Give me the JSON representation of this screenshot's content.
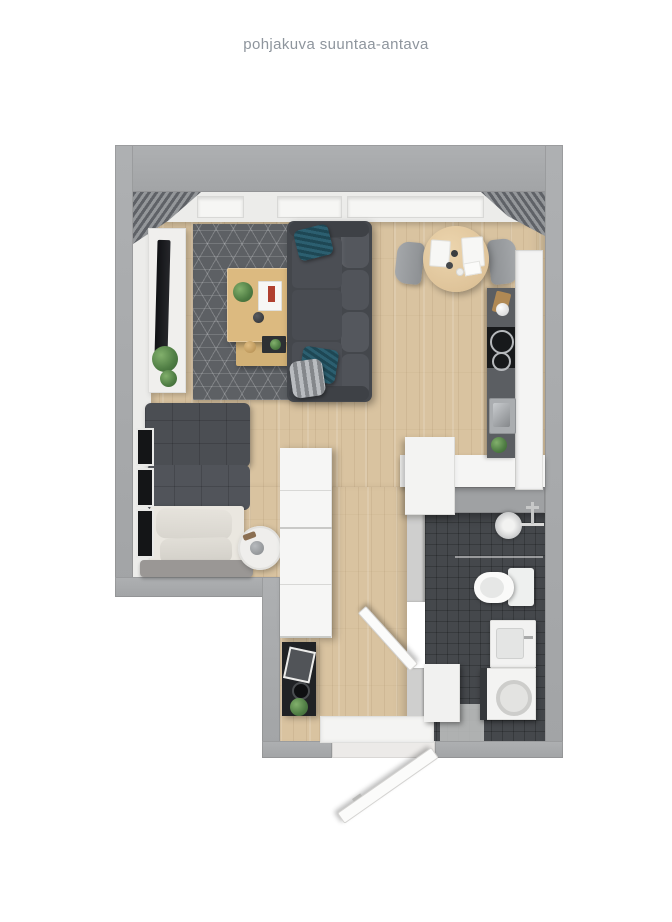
{
  "caption": "pohjakuva suuntaa-antava",
  "floorplan": {
    "description": "3D top-down floor plan of a studio apartment, indicative only",
    "rooms": [
      {
        "name": "living-sleeping-area",
        "items": [
          "corner-blinds",
          "windows",
          "tv-sideboard",
          "tv",
          "plants",
          "geometric-rug",
          "coffee-table",
          "lower-coffee-table",
          "sofa",
          "teal-pillows",
          "patterned-pillow",
          "bed",
          "duvet",
          "pillows",
          "headboard",
          "round-side-table",
          "wall-frames"
        ]
      },
      {
        "name": "dining-area",
        "items": [
          "round-dining-table",
          "dining-chair-left",
          "dining-chair-right",
          "place-settings"
        ]
      },
      {
        "name": "kitchen",
        "items": [
          "dark-worktop",
          "cooktop",
          "kitchen-sink",
          "kitchen-cabinets",
          "tall-cabinet",
          "kitchen-plant",
          "kettle"
        ]
      },
      {
        "name": "hallway",
        "items": [
          "wardrobe",
          "black-console",
          "picture-frame",
          "plant",
          "door-mat",
          "entry-door"
        ]
      },
      {
        "name": "bathroom",
        "items": [
          "shower-head",
          "shower-glass",
          "toilet",
          "washbasin-cabinet",
          "washing-machine",
          "bathroom-cabinet",
          "bathroom-door"
        ]
      }
    ],
    "colors": {
      "wall": "#a6a8aa",
      "wood_floor": "#d9c3a0",
      "rug": "#5d6064",
      "sofa": "#46494e",
      "bed_duvet": "#4b4e53",
      "bathroom_floor": "#45484c",
      "accent_teal": "#2c5f70",
      "counter_dark": "#5b5e62",
      "furniture_white": "#f3f3f2",
      "table_wood": "#d9b97f",
      "caption_text": "#8e959d"
    }
  }
}
